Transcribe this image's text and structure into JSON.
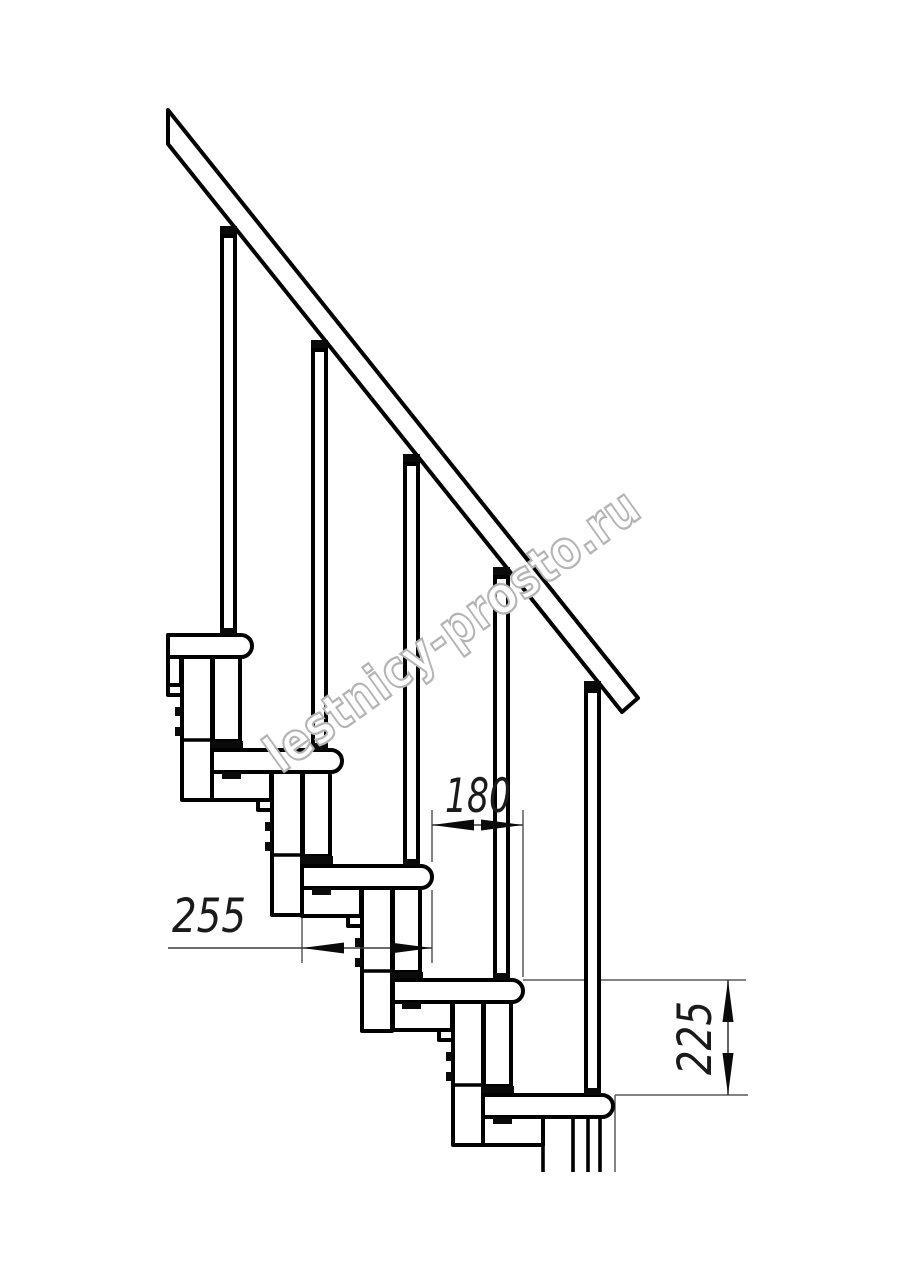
{
  "drawing_type": "staircase-section-technical-drawing",
  "watermark": "lestnicy-prosto.ru",
  "dimensions": {
    "tread_depth": "255",
    "going": "180",
    "rise": "225"
  },
  "colors": {
    "background": "#ffffff",
    "main_lines": "#000000",
    "dimension_lines": "#5a5a5a",
    "watermark_outline": "#b4b4b4"
  },
  "elements": {
    "treads_visible": 5,
    "balusters_visible": 5,
    "handrail": "diagonal-top-left-to-right"
  }
}
